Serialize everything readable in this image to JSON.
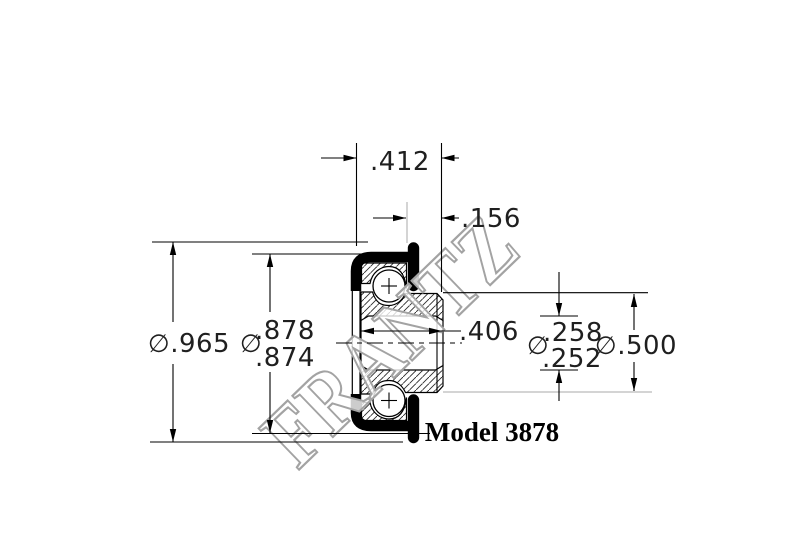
{
  "drawing": {
    "watermark": "FRANTZ",
    "model_label": "Model 3878",
    "diameter_symbol": "∅",
    "line_color": "#000000",
    "watermark_color": "#a3a3a3",
    "dimensions": {
      "overall_width": ".412",
      "flange_face_offset": ".156",
      "flange_diameter": ".965",
      "housing_diameter_max": ".878",
      "housing_diameter_min": ".874",
      "inner_ring_width": ".406",
      "bore_diameter_max": ".258",
      "bore_diameter_min": ".252",
      "inner_ring_extension_diameter": ".500"
    }
  }
}
